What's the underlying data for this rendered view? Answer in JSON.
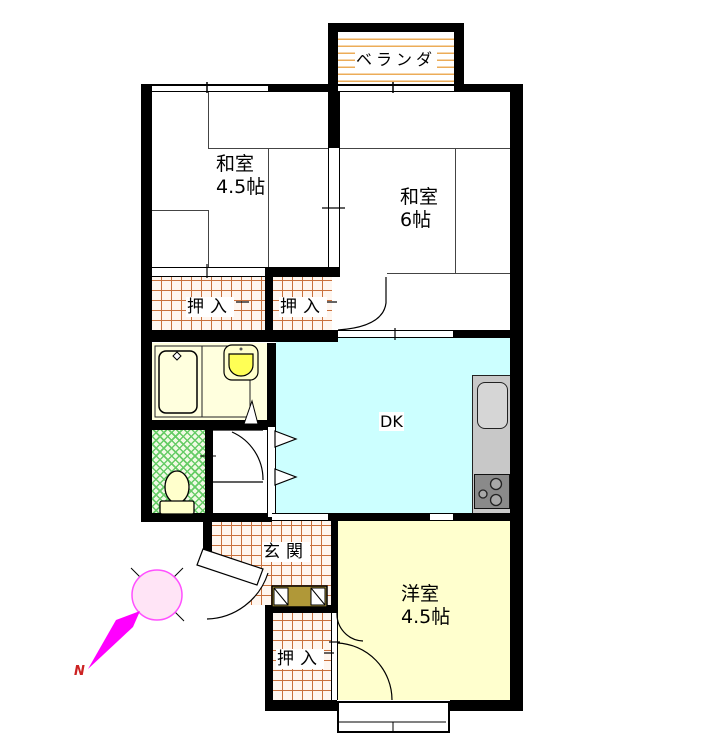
{
  "plan_title": "apartment-floor-plan",
  "labels": {
    "veranda": "ベランダ",
    "washitsu_45": {
      "name": "和室",
      "size": "4.5帖"
    },
    "washitsu_6": {
      "name": "和室",
      "size": "6帖"
    },
    "oshiire_left": "押入",
    "oshiire_right": "押入",
    "oshiire_bottom": "押入",
    "dk": "DK",
    "genkan": "玄関",
    "youshitsu": {
      "name": "洋室",
      "size": "4.5帖"
    },
    "compass_north": "N"
  },
  "colors": {
    "wall": "#000000",
    "dk_floor": "#CCFFFF",
    "youshitsu_floor": "#FFFFCE",
    "bath_floor": "#FFFFDE",
    "fixture_fill": "#FFFFCC",
    "basin_bowl": "#FFFF55",
    "hatch_line": "#C8703C",
    "balcony_line": "#ECAC58",
    "toilet_line": "#66CC66",
    "toilet_bg": "#F0FAE4",
    "counter": "#C8C8C8",
    "sink": "#D6D6D6",
    "stove": "#8A8A8A",
    "cabinet": "#B09838",
    "compass_arrow": "#FF00FF",
    "compass_circle_stroke": "#FF50FF",
    "compass_circle_fill": "#FFE4F6",
    "north_text": "#CC2222"
  }
}
